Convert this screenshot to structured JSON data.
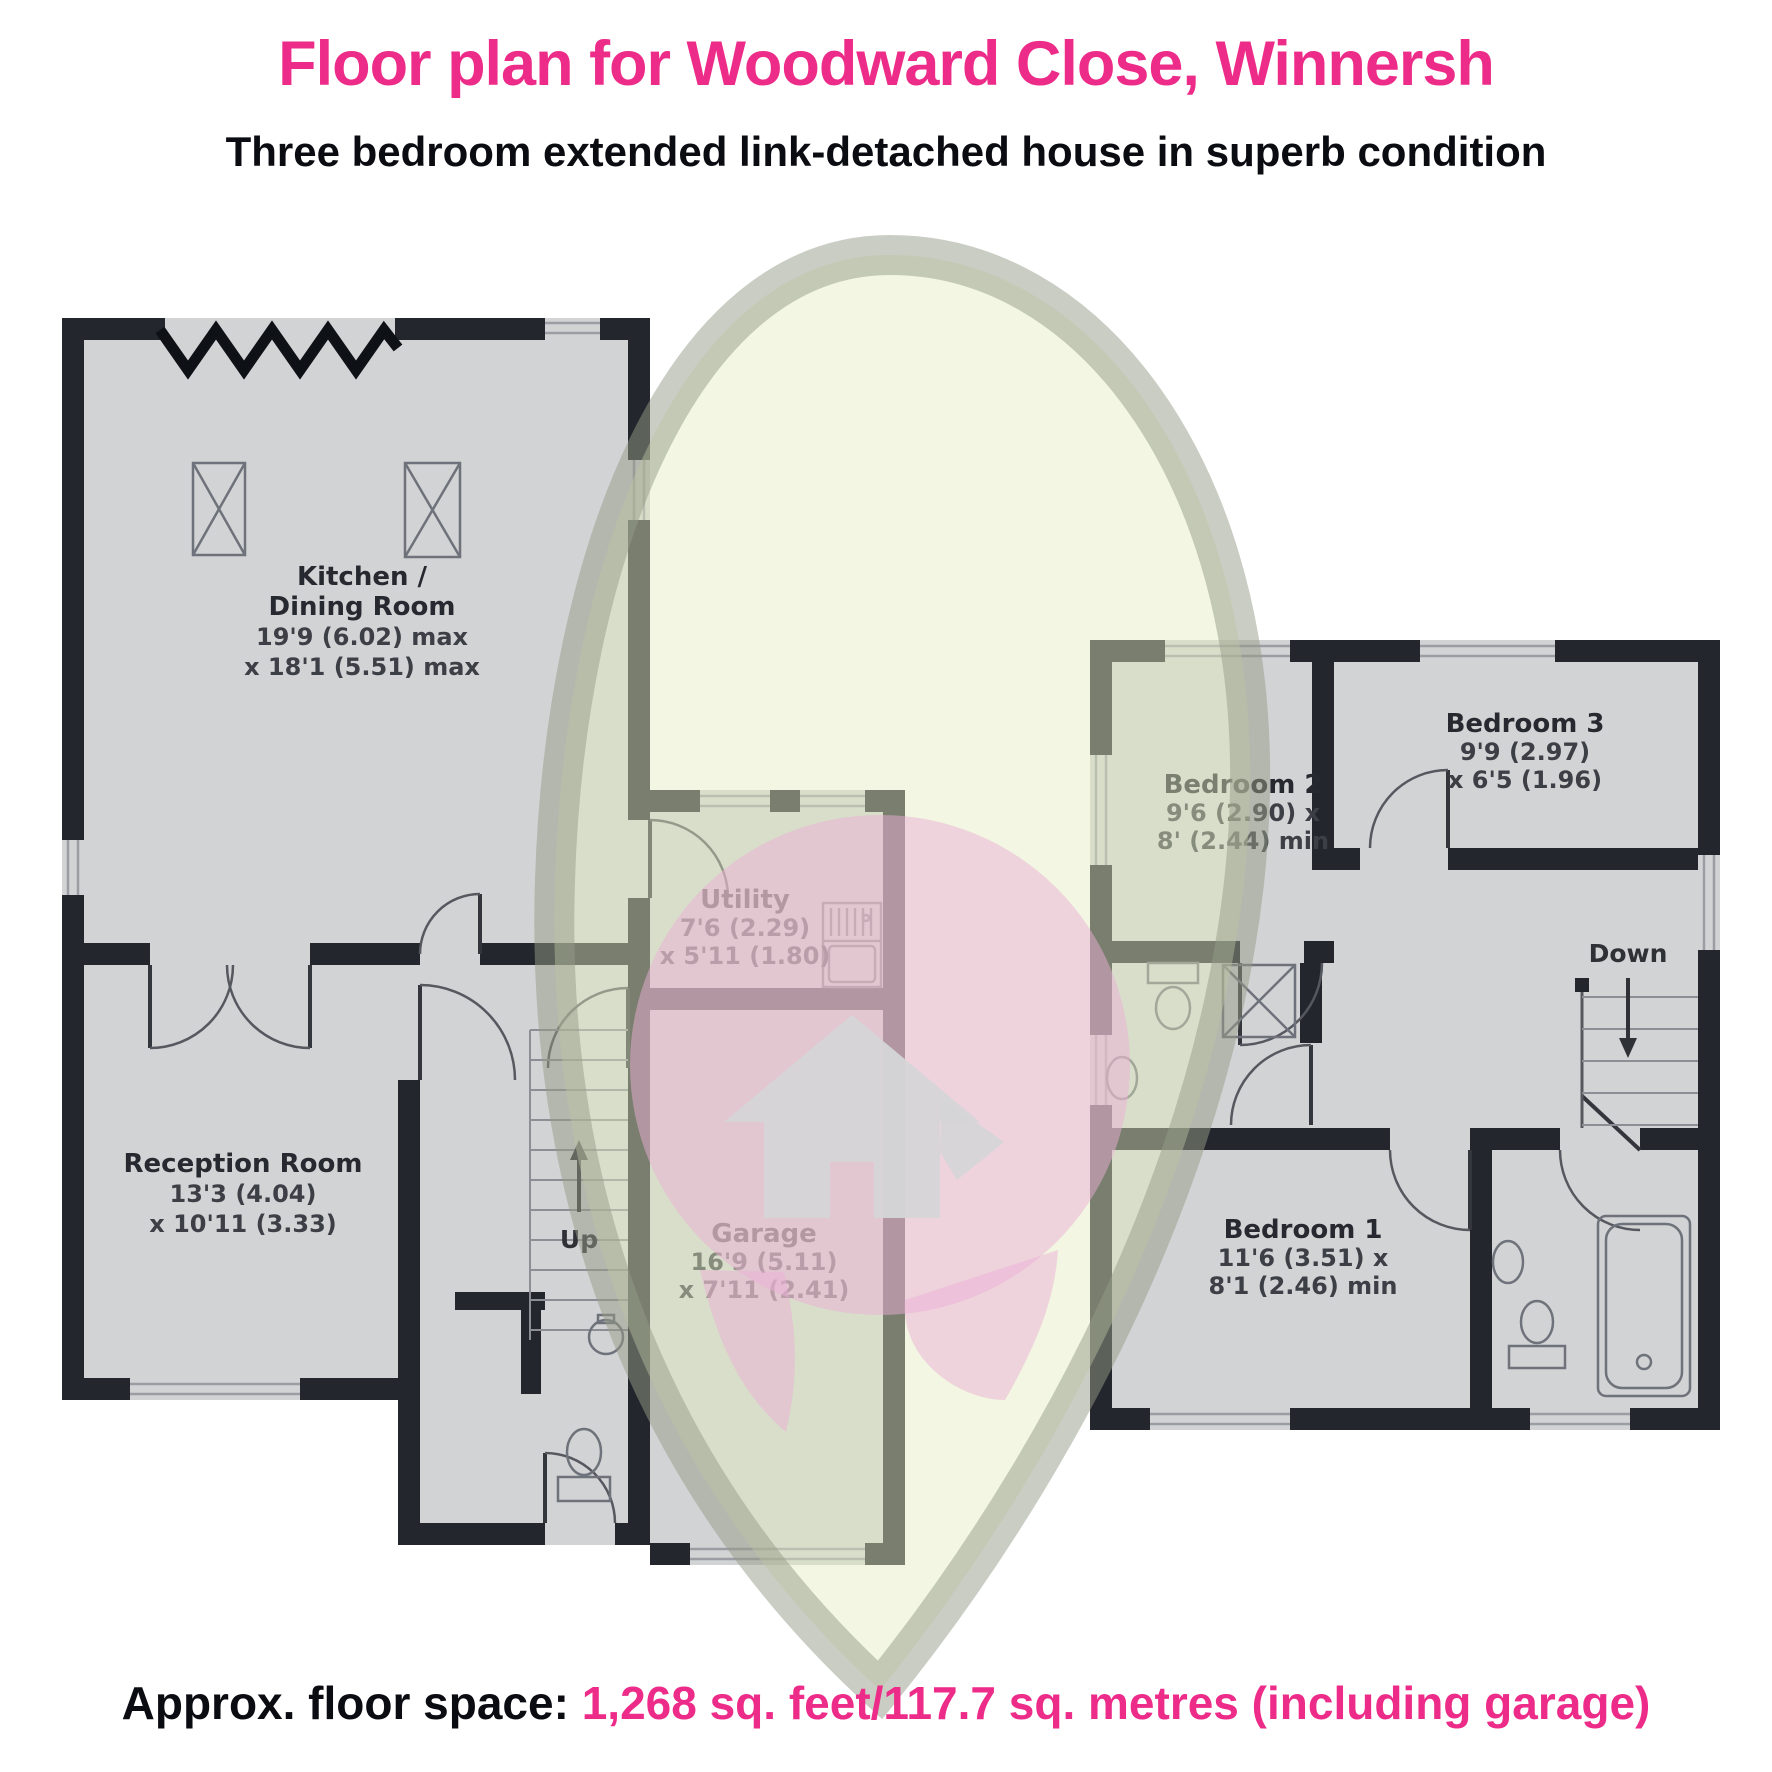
{
  "header": {
    "title": "Floor plan for Woodward Close, Winnersh",
    "subtitle": "Three bedroom extended link-detached house in superb condition"
  },
  "footer": {
    "label": "Approx. floor space:",
    "value": "1,268 sq. feet/117.7 sq. metres (including garage)"
  },
  "colors": {
    "accent_pink": "#ED2B88",
    "text_black": "#0B0B12",
    "wall": "#23262D",
    "floor_fill": "#D2D3D5",
    "watermark_green": "#F4F9E6",
    "watermark_ring": "#A9AE9E",
    "watermark_pink": "#ECAFD6",
    "watermark_house": "#D5D5D7"
  },
  "ground_floor": {
    "kitchen": {
      "name_line1": "Kitchen /",
      "name_line2": "Dining Room",
      "dim_line1": "19'9 (6.02) max",
      "dim_line2": "x 18'1 (5.51) max"
    },
    "reception": {
      "name": "Reception Room",
      "dim_line1": "13'3 (4.04)",
      "dim_line2": "x 10'11 (3.33)"
    },
    "utility": {
      "name": "Utility",
      "dim_line1": "7'6 (2.29)",
      "dim_line2": "x 5'11 (1.80)"
    },
    "garage": {
      "name": "Garage",
      "dim_line1": "16'9 (5.11)",
      "dim_line2": "x 7'11 (2.41)"
    },
    "stairs_label": "Up"
  },
  "first_floor": {
    "bedroom2": {
      "name": "Bedroom 2",
      "dim_line1": "9'6 (2.90) x",
      "dim_line2": "8' (2.44) min"
    },
    "bedroom3": {
      "name": "Bedroom 3",
      "dim_line1": "9'9 (2.97)",
      "dim_line2": "x 6'5 (1.96)"
    },
    "bedroom1": {
      "name": "Bedroom 1",
      "dim_line1": "11'6 (3.51) x",
      "dim_line2": "8'1 (2.46) min"
    },
    "stairs_label": "Down"
  }
}
